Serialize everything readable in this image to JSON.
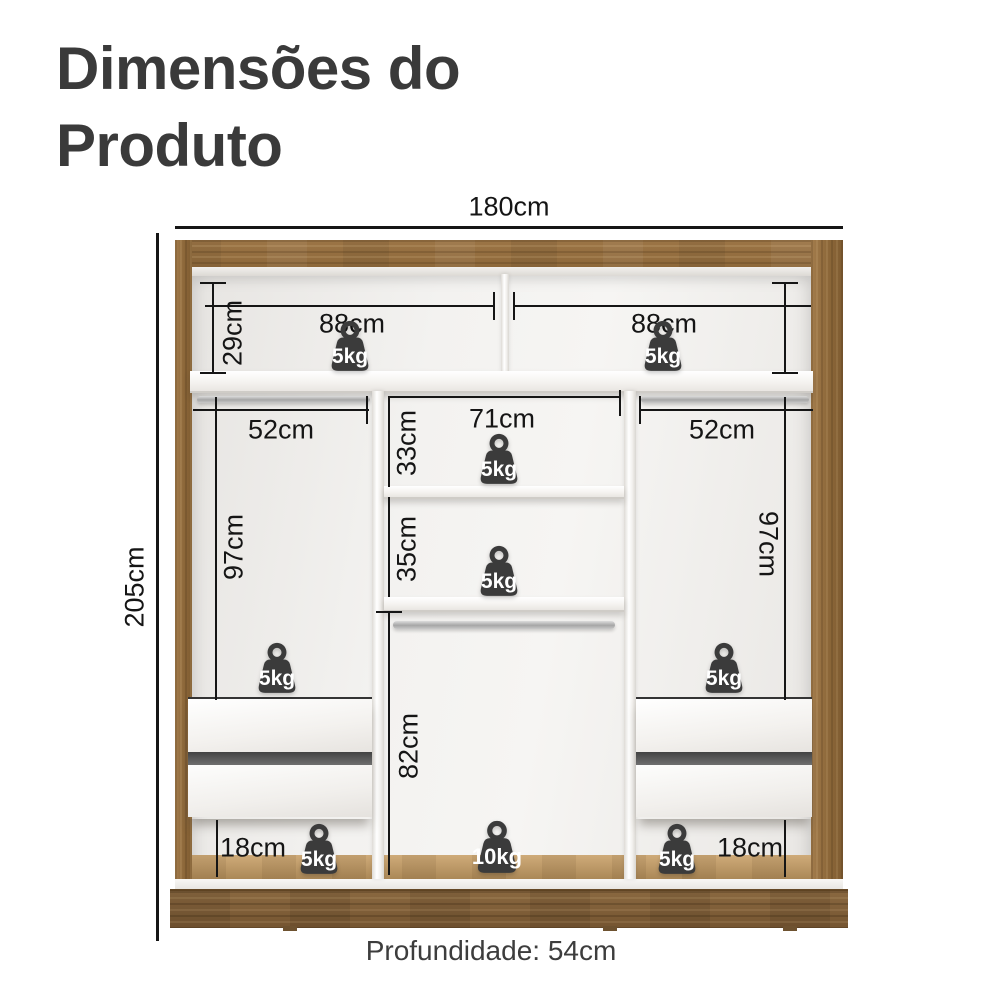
{
  "title": {
    "line1": "Dimensões do",
    "line2": "Produto"
  },
  "product": {
    "total_width": "180cm",
    "total_height": "205cm",
    "depth_note": "Profundidade: 54cm",
    "top_section_height": "29cm",
    "top_left_width": "88cm",
    "top_right_width": "88cm",
    "left_column_width": "52cm",
    "right_column_width": "52cm",
    "center_column_width": "71cm",
    "center_upper_height": "33cm",
    "center_middle_height": "35cm",
    "center_lower_height": "82cm",
    "left_column_height": "97cm",
    "right_column_height": "97cm",
    "left_base_height": "18cm",
    "right_base_height": "18cm"
  },
  "weights": [
    {
      "location": "top-left-shelf",
      "label": "5kg"
    },
    {
      "location": "top-right-shelf",
      "label": "5kg"
    },
    {
      "location": "center-upper-shelf",
      "label": "5kg"
    },
    {
      "location": "center-middle-shelf",
      "label": "5kg"
    },
    {
      "location": "left-column-drawer-top",
      "label": "5kg"
    },
    {
      "location": "right-column-drawer-top",
      "label": "5kg"
    },
    {
      "location": "bottom-left-base",
      "label": "5kg"
    },
    {
      "location": "bottom-center-base",
      "label": "10kg"
    },
    {
      "location": "bottom-right-base",
      "label": "5kg"
    }
  ],
  "colors": {
    "wood": "#9a7343",
    "wood_dark": "#7c5c33",
    "weight_badge": "#3b3b3b",
    "dimension_line": "#151515",
    "title_text": "#3a3a3a"
  }
}
